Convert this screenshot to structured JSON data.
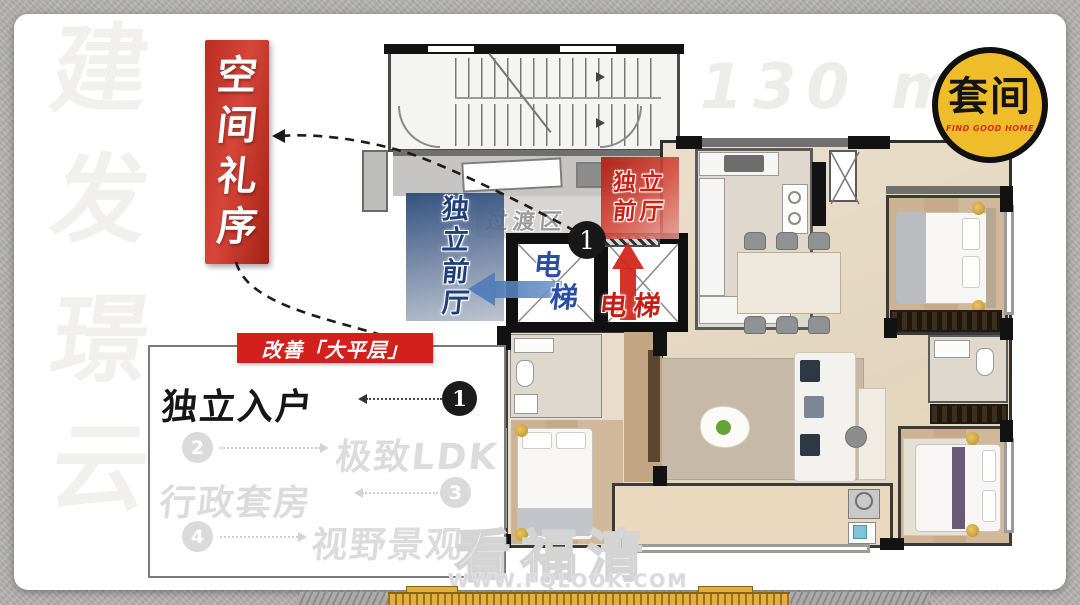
{
  "watermark_left": {
    "chars": [
      "建",
      "发",
      "璟",
      "云"
    ]
  },
  "banner": {
    "text": "空间礼序",
    "chars": [
      "空",
      "间",
      "礼",
      "序"
    ],
    "color": "#c23227"
  },
  "area_label": {
    "value": "130 m",
    "sup": "2"
  },
  "logo": {
    "name": "套间",
    "tagline": "FIND GOOD HOME",
    "bg_color": "#efbd29",
    "tagline_color": "#d9291d"
  },
  "plan": {
    "blue_hall": {
      "chars": [
        "独",
        "立",
        "前",
        "厅"
      ],
      "label": "独立前厅",
      "color": "#2a497a"
    },
    "red_hall": {
      "line1": "独立",
      "line2": "前厅",
      "label": "独立前厅",
      "color": "#b02117"
    },
    "transition": {
      "label": "过渡区"
    },
    "elevator_blue": {
      "char1": "电",
      "char2": "梯",
      "label": "电梯",
      "arrow_color": "#4f7cb8"
    },
    "elevator_red": {
      "label": "电梯",
      "arrow_color": "#d2281e"
    },
    "marker": {
      "number": "1"
    }
  },
  "info_box": {
    "tag": "改善「大平层」",
    "tag_color": "#d2211c",
    "items": [
      {
        "num": "1",
        "label": "独立入户",
        "active": true
      },
      {
        "num": "2",
        "label": "极致LDK",
        "active": false
      },
      {
        "num": "3",
        "label": "行政套房",
        "active": false
      },
      {
        "num": "4",
        "label": "视野景观",
        "active": false
      }
    ]
  },
  "site_watermark": {
    "title": "看福清",
    "url": "WWW.FQLOOK.COM"
  }
}
